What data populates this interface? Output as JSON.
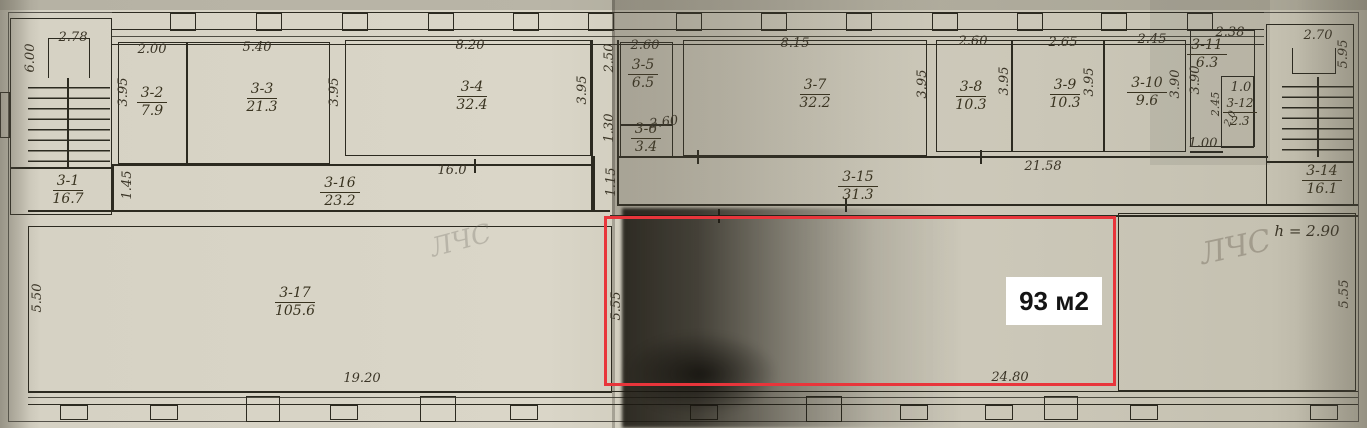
{
  "highlight": {
    "label": "93 м2",
    "color": "#e8353b"
  },
  "annotations": {
    "height_note": "h = 2.90",
    "pencil_left": "ЛЧС",
    "pencil_right": "ЛЧС"
  },
  "rooms": [
    {
      "id": "3-1",
      "area": "16.7"
    },
    {
      "id": "3-2",
      "area": "7.9"
    },
    {
      "id": "3-3",
      "area": "21.3"
    },
    {
      "id": "3-4",
      "area": "32.4"
    },
    {
      "id": "3-5",
      "area": "6.5"
    },
    {
      "id": "3-6",
      "area": "3.4"
    },
    {
      "id": "3-7",
      "area": "32.2"
    },
    {
      "id": "3-8",
      "area": "10.3"
    },
    {
      "id": "3-9",
      "area": "10.3"
    },
    {
      "id": "3-10",
      "area": "9.6"
    },
    {
      "id": "3-11",
      "area": "6.3"
    },
    {
      "id": "3-12",
      "area": "2.3"
    },
    {
      "id": "3-14",
      "area": "16.1"
    },
    {
      "id": "3-15",
      "area": "31.3"
    },
    {
      "id": "3-16",
      "area": "23.2"
    },
    {
      "id": "3-17",
      "area": "105.6"
    }
  ],
  "dims": {
    "d278": "2.78",
    "d600": "6.00",
    "d200": "2.00",
    "d395_32": "3.95",
    "d540": "5.40",
    "d395_33": "3.95",
    "d820": "8.20",
    "d395_34r": "3.95",
    "d250": "2.50",
    "d130": "1.30",
    "d260_35": "2.60",
    "d260_36": "2.60",
    "d815": "8.15",
    "d395_37": "3.95",
    "d395_38r": "3.95",
    "d260_38": "2.60",
    "d265": "2.65",
    "d395_39": "3.95",
    "d245": "2.45",
    "d390_310": "3.90",
    "d238": "2.38",
    "d390_311": "3.90",
    "d10": "1.0",
    "d245_312": "2.45",
    "d20": "2.0",
    "d100": "1.00",
    "d270": "2.70",
    "d595": "5.95",
    "d145": "1.45",
    "d115": "1.15",
    "d160": "16.0",
    "d2158": "21.58",
    "d550": "5.50",
    "d1920": "19.20",
    "d555l": "5.55",
    "d2480": "24.80",
    "d555r": "5.55"
  }
}
